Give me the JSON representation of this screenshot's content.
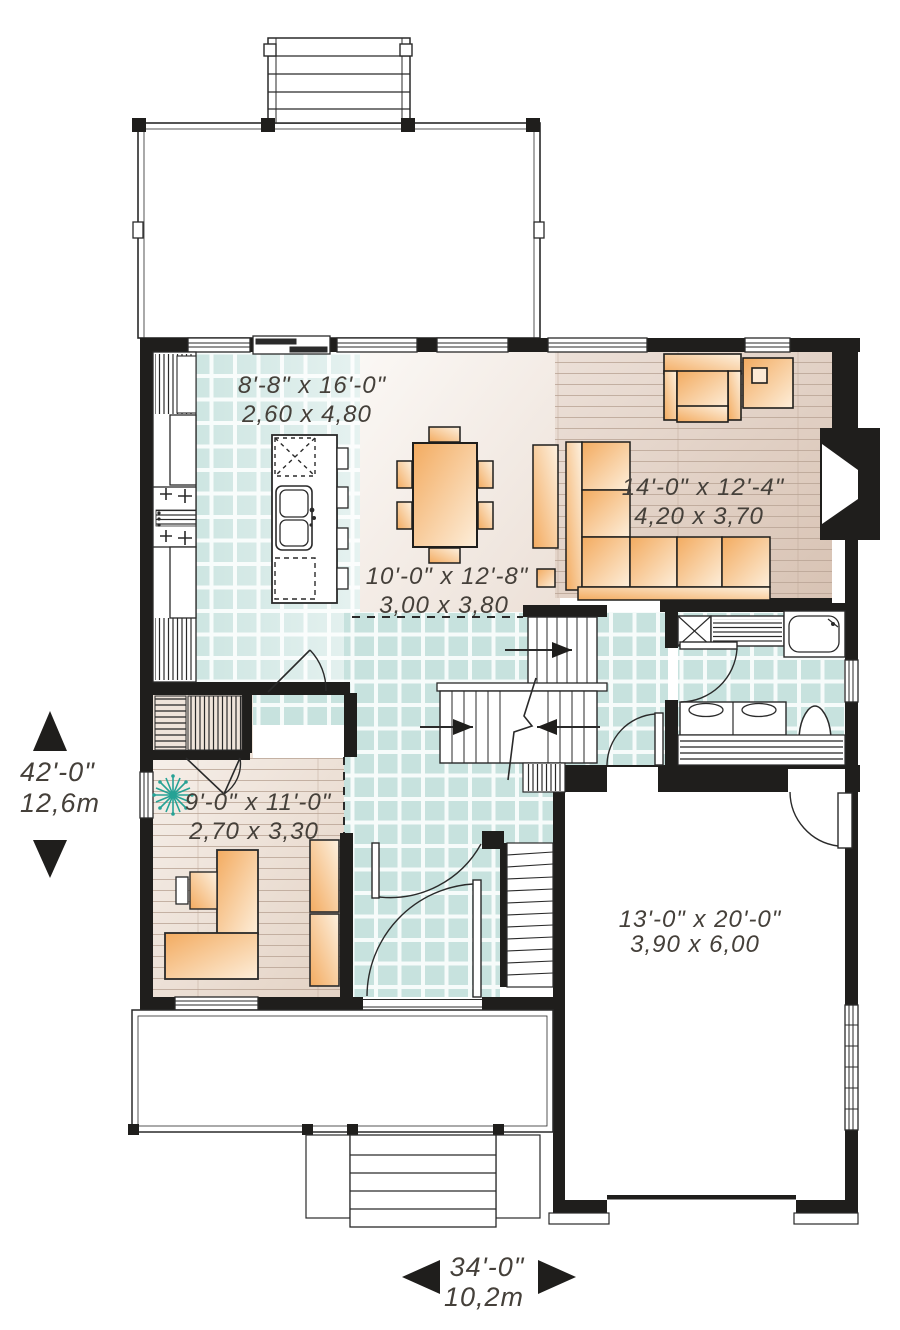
{
  "plan_type": "floor-plan",
  "rooms": {
    "kitchen": {
      "imperial": "8'-8\" x 16'-0\"",
      "metric": "2,60 x 4,80"
    },
    "dining": {
      "imperial": "10'-0\" x 12'-8\"",
      "metric": "3,00 x 3,80"
    },
    "living": {
      "imperial": "14'-0\" x 12'-4\"",
      "metric": "4,20 x 3,70"
    },
    "office": {
      "imperial": "9'-0\" x 11'-0\"",
      "metric": "2,70 x 3,30"
    },
    "garage": {
      "imperial": "13'-0\" x 20'-0\"",
      "metric": "3,90 x 6,00"
    }
  },
  "overall": {
    "depth": {
      "imperial": "42'-0\"",
      "metric": "12,6m"
    },
    "width": {
      "imperial": "34'-0\"",
      "metric": "10,2m"
    }
  },
  "colors": {
    "wall": "#1f1e1c",
    "tile": "#c7e2de",
    "wood_living": "#e2d2c6",
    "wood_office": "#eadcd1",
    "furniture": "#f4b878",
    "plant": "#26a295",
    "text": "#45403a"
  }
}
